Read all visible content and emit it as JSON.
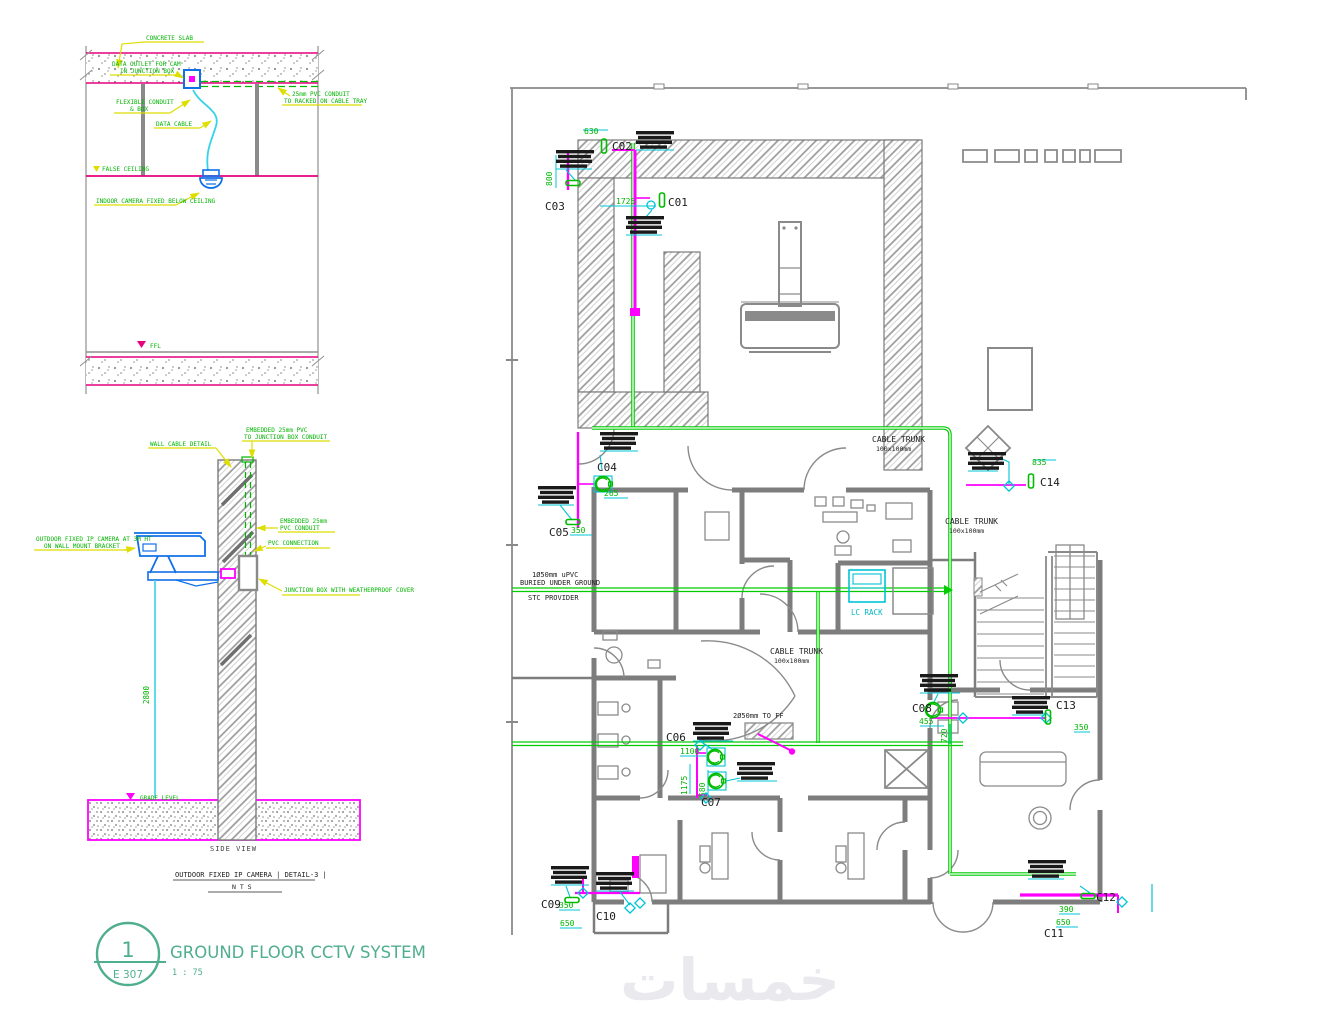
{
  "title_block": {
    "detail_number": "1",
    "sheet_number": "E 307",
    "title": "GROUND FLOOR CCTV SYSTEM",
    "scale": "1 : 75"
  },
  "watermark_text": "خمسات",
  "detail_ceiling": {
    "labels": {
      "concrete_slab": "CONCRETE SLAB",
      "outlet_1": "DATA OUTLET FOR CAM",
      "outlet_2": "IN JUNCTION BOX",
      "flex_1": "FLEXIBLE CONDUIT",
      "flex_2": "& BOX",
      "data_cable": "DATA CABLE",
      "conduit_1": "25mm PVC CONDUIT",
      "conduit_2": "TO RACKED ON CABLE TRAY",
      "false_ceiling": "FALSE CEILING",
      "camera": "INDOOR CAMERA FIXED BELOW CEILING",
      "ffl": "FFL"
    }
  },
  "detail_side": {
    "labels": {
      "embedded_top_1": "EMBEDDED 25mm PVC",
      "embedded_top_2": "TO JUNCTION BOX CONDUIT",
      "wall": "WALL CABLE DETAIL",
      "embedded_mid_1": "EMBEDDED 25mm",
      "embedded_mid_2": "PVC CONDUIT",
      "pvc_connection": "PVC CONNECTION",
      "junction_box": "JUNCTION BOX WITH WEATHERPROOF COVER",
      "camera_1": "OUTDOOR FIXED IP CAMERA AT 3M HT",
      "camera_2": "ON WALL MOUNT BRACKET",
      "grade": "GRADE LEVEL",
      "height_dim": "2800",
      "side_view": "SIDE VIEW",
      "caption": "OUTDOOR FIXED IP CAMERA | DETAIL-3 |",
      "nts": "N T S"
    }
  },
  "floor_plan": {
    "texts": {
      "cable_trunk": "CABLE TRUNK",
      "trunk_size": "100x100mm",
      "buried_1": "1Ø50mm uPVC",
      "buried_2": "BURIED UNDER GROUND",
      "stc": "STC PROVIDER",
      "to_ff": "2Ø50mm TO FF",
      "lc_rack": "LC RACK"
    },
    "cameras": [
      {
        "id": "C01"
      },
      {
        "id": "C02"
      },
      {
        "id": "C03"
      },
      {
        "id": "C04"
      },
      {
        "id": "C05"
      },
      {
        "id": "C06"
      },
      {
        "id": "C07"
      },
      {
        "id": "C08"
      },
      {
        "id": "C09"
      },
      {
        "id": "C10"
      },
      {
        "id": "C11"
      },
      {
        "id": "C12"
      },
      {
        "id": "C13"
      },
      {
        "id": "C14"
      }
    ],
    "dimensions": [
      "630",
      "800",
      "1725",
      "265",
      "350",
      "1100",
      "1175",
      "580",
      "455",
      "720",
      "835",
      "350",
      "650",
      "390",
      "650",
      "350"
    ]
  }
}
